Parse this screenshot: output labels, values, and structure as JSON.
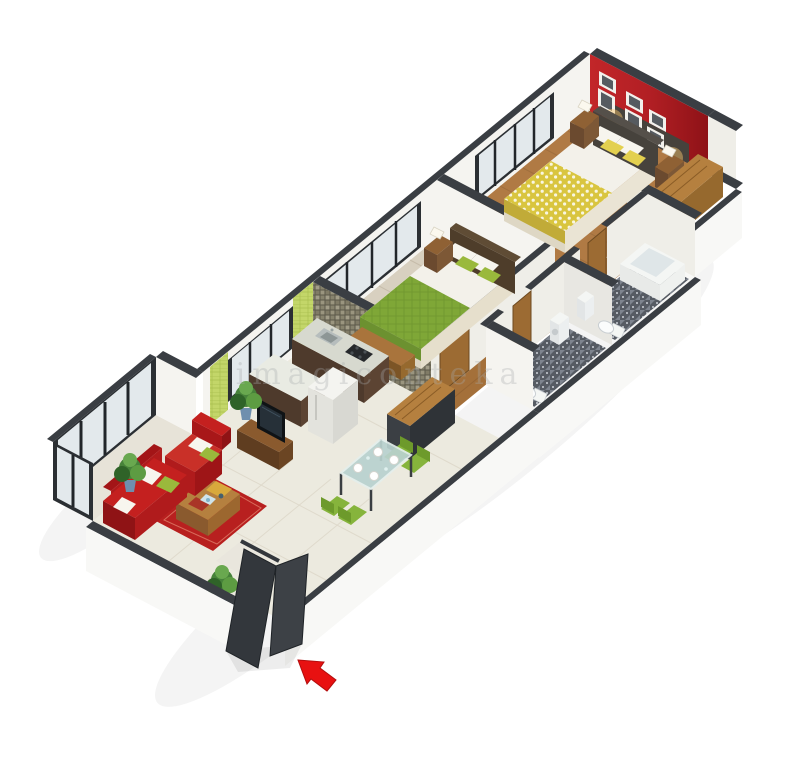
{
  "page": {
    "title": "2 BHK apartment isometric 3D floor plan",
    "type": "isometric-3d-floor-plan",
    "background": "#ffffff"
  },
  "watermark": {
    "text": "imagiconteka",
    "color": "#a8abad"
  },
  "entrance_arrow": {
    "meaning": "main entrance direction",
    "color": "#e81111"
  },
  "rooms": [
    {
      "id": "master-bedroom",
      "name": "Master bedroom",
      "accent": "red feature wall with six picture frames",
      "furniture": [
        "double bed with yellow polka-dot duvet",
        "two nightstands with lamps",
        "wooden wardrobe"
      ]
    },
    {
      "id": "bedroom-2",
      "name": "Bedroom 2",
      "furniture": [
        "double bed with green duvet",
        "nightstand with lamp",
        "wooden foot bench"
      ]
    },
    {
      "id": "kitchen",
      "name": "Kitchen",
      "accent": "mosaic tile wall and green tile backsplash",
      "furniture": [
        "counter with sink and hob",
        "second counter",
        "refrigerator"
      ]
    },
    {
      "id": "bathroom-1",
      "name": "Bathroom 1",
      "furniture": [
        "bathtub",
        "toilet",
        "washbasin"
      ]
    },
    {
      "id": "bathroom-2",
      "name": "Bathroom 2",
      "furniture": [
        "toilet",
        "washbasin"
      ]
    },
    {
      "id": "corridor",
      "name": "Corridor"
    },
    {
      "id": "dining-area",
      "name": "Dining area",
      "furniture": [
        "glass dining table",
        "four green chairs",
        "wooden side table"
      ]
    },
    {
      "id": "living-room",
      "name": "Living room",
      "furniture": [
        "red sofa",
        "red armchair",
        "coffee table on red rug",
        "TV unit",
        "potted plants"
      ]
    },
    {
      "id": "window-bay",
      "name": "Window bay"
    },
    {
      "id": "entrance",
      "name": "Entrance",
      "furniture": [
        "open double door"
      ]
    }
  ],
  "colors": {
    "background": "#ffffff",
    "wall_top": "#3a3e43",
    "wall_white": "#f5f4f0",
    "wall_band": "#f8f8f6",
    "accent_wall_red": "#b21f24",
    "red_light": "#c22629",
    "red_dark": "#8e1217",
    "sofa_red": "#c4201f",
    "rug_red": "#b8201f",
    "duvet_yellow": "#d9c53f",
    "duvet_green": "#7fa737",
    "chair_green": "#86b43c",
    "pillow_green": "#9ab93c",
    "wood_floor": "#b07a44",
    "corridor_wood": "#a4703a",
    "wood_furniture": "#b5803f",
    "door_wood": "#9c6b33",
    "kitchen_cabinet": "#4e3a2c",
    "marble": "#d7d9cf",
    "bath_tile": "#565b63",
    "mosaic": "#5c594a",
    "backsplash_green": "#c3d669",
    "floor_cream": "#eceadf",
    "floor_br2": "#d8d0c0",
    "bay_floor": "#e7e3d8",
    "glass": "#b9d2cf",
    "tv_black": "#0f1316",
    "window_frame": "#2b2f33",
    "window_pane": "#e3e9ec",
    "plant_green": "#47823a",
    "pot_blue": "#6f8fae",
    "arrow_red": "#e81111",
    "watermark": "#a8abad",
    "fixture_white": "#f4f6f4"
  }
}
